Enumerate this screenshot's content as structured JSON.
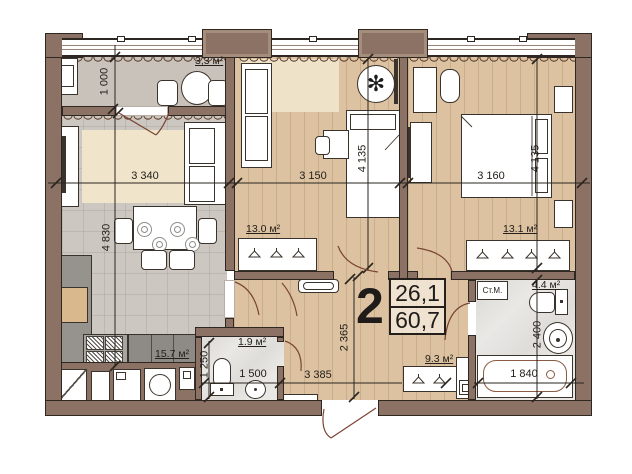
{
  "plan": {
    "badge": {
      "room_count": "2",
      "area_living": "26,1",
      "area_total": "60,7"
    },
    "areas": {
      "loggia": "3,3 м²",
      "room1": "13.0 м²",
      "bedroom": "13.1 м²",
      "kitchen_living": "15.7 м²",
      "wc": "1.9 м²",
      "hall": "9.3 м²",
      "bathroom": "4.4 м²"
    },
    "equipment": {
      "washing_machine": "Ст.М."
    },
    "dimensions": {
      "loggia_height": "1 000",
      "living_width": "3 340",
      "room1_width": "3 150",
      "bedroom_width": "3 160",
      "living_height": "4 830",
      "room1_height": "4 135",
      "bedroom_height": "4 135",
      "hall_height": "2 365",
      "bathroom_height": "2 400",
      "wc_height": "1 250",
      "wc_width": "1 500",
      "hall_width": "3 385",
      "bath_length": "1 840"
    },
    "icons": {
      "plant_glyph": "✻"
    }
  }
}
